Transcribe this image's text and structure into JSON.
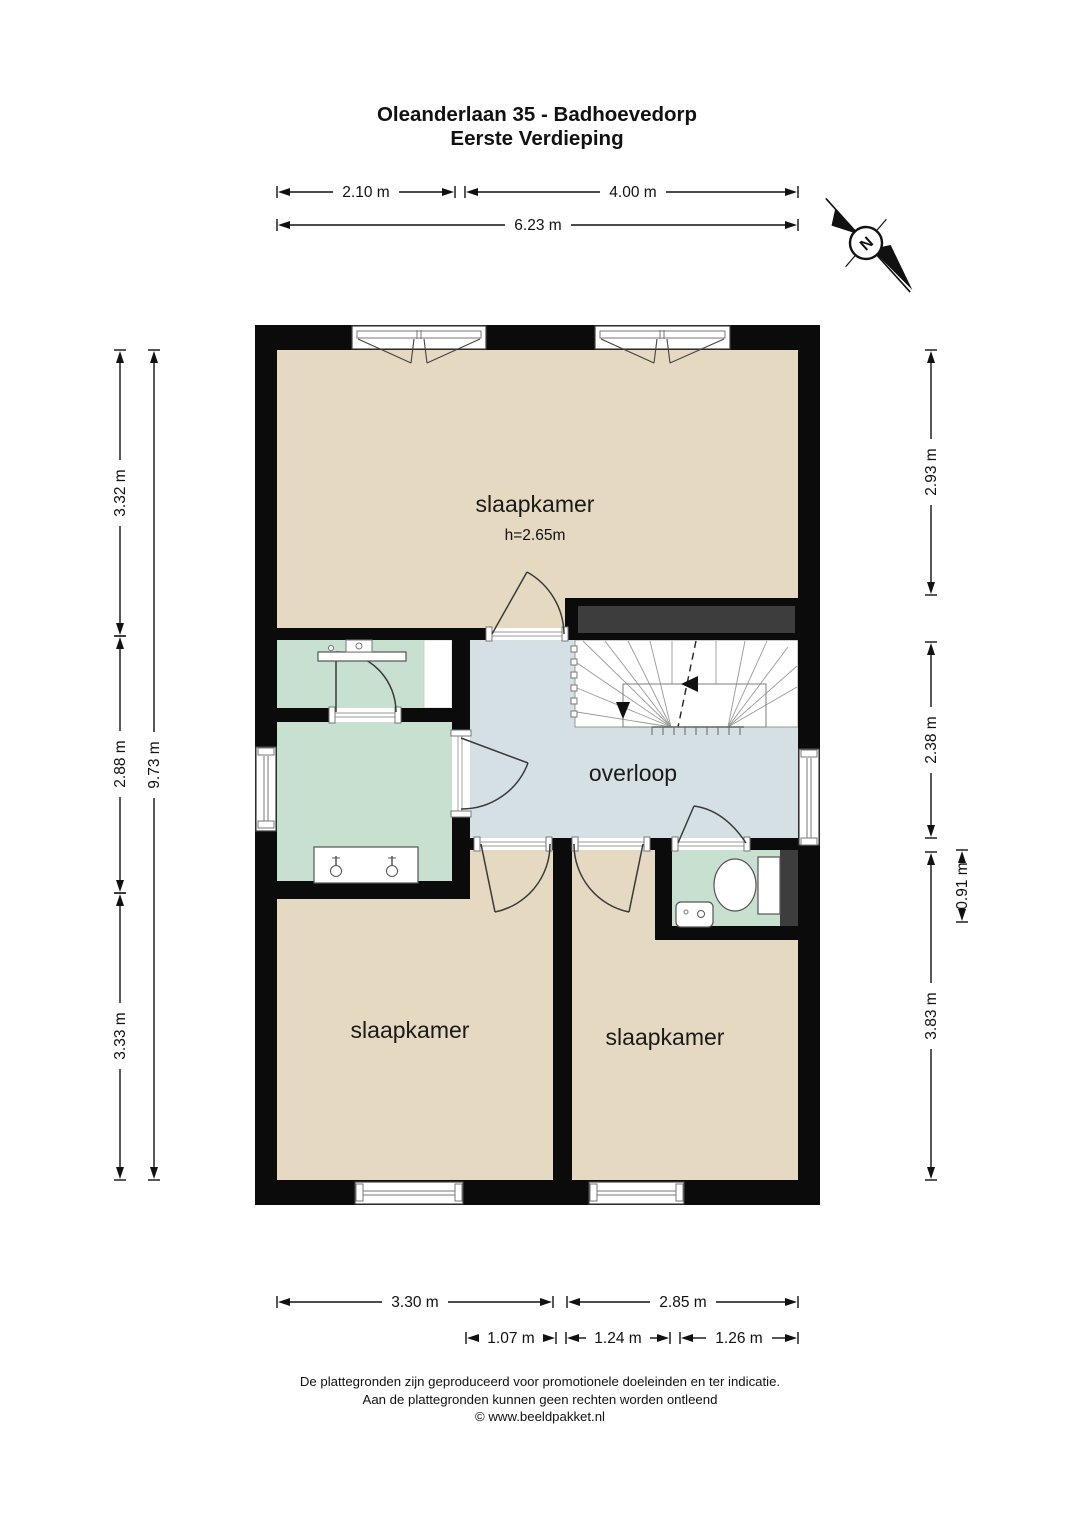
{
  "title": {
    "line1": "Oleanderlaan 35 - Badhoevedorp",
    "line2": "Eerste Verdieping"
  },
  "compass": {
    "label": "N"
  },
  "rooms": {
    "bedroom_top": {
      "label": "slaapkamer",
      "ceiling_height": "h=2.65m"
    },
    "landing": {
      "label": "overloop"
    },
    "bedroom_left": {
      "label": "slaapkamer"
    },
    "bedroom_right": {
      "label": "slaapkamer"
    }
  },
  "dimensions": {
    "top": [
      {
        "label": "2.10 m"
      },
      {
        "label": "4.00 m"
      },
      {
        "label": "6.23 m"
      }
    ],
    "left": [
      {
        "label": "3.32 m"
      },
      {
        "label": "2.88 m"
      },
      {
        "label": "3.33 m"
      },
      {
        "label": "9.73 m"
      }
    ],
    "right": [
      {
        "label": "2.93 m"
      },
      {
        "label": "2.38 m"
      },
      {
        "label": "0.91 m"
      },
      {
        "label": "3.83 m"
      }
    ],
    "bottom": [
      {
        "label": "3.30 m"
      },
      {
        "label": "2.85 m"
      },
      {
        "label": "1.07 m"
      },
      {
        "label": "1.24 m"
      },
      {
        "label": "1.26 m"
      }
    ]
  },
  "footer": {
    "line1": "De plattegronden zijn geproduceerd voor promotionele doeleinden en ter indicatie.",
    "line2": "Aan de plattegronden kunnen geen rechten worden ontleend",
    "line3": "© www.beeldpakket.nl"
  },
  "colors": {
    "wall": "#0b0b0b",
    "floor": "#e5d9c1",
    "wet_room": "#c7e0d0",
    "landing": "#d4e0e4",
    "void": "#3d3d3d"
  }
}
